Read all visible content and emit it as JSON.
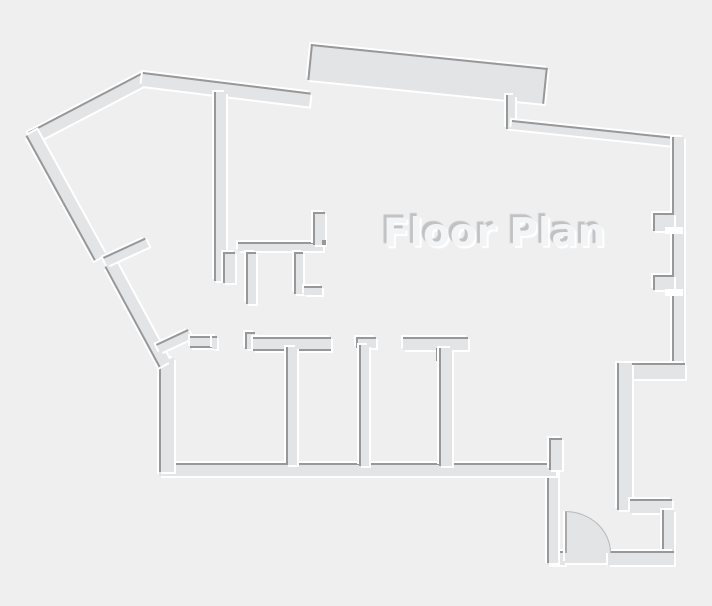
{
  "title": "Floor Plan",
  "drawing": {
    "type": "architectural-floor-plan",
    "style": "embossed-line-drawing",
    "features": {
      "door_swing": "quarter-arc door at bottom-right entry vestibule",
      "rooms_bottom_row": 3,
      "top_bay": "thick angled wall band at top center",
      "right_wall_piers": 2
    }
  },
  "colors": {
    "background": "#efeff0",
    "wall_fill": "#e3e4e6",
    "wall_shade": "#97989a",
    "wall_highlight": "#ffffff",
    "title_color": "#f3f4f5",
    "title_shadow": "#c1c2c4"
  }
}
